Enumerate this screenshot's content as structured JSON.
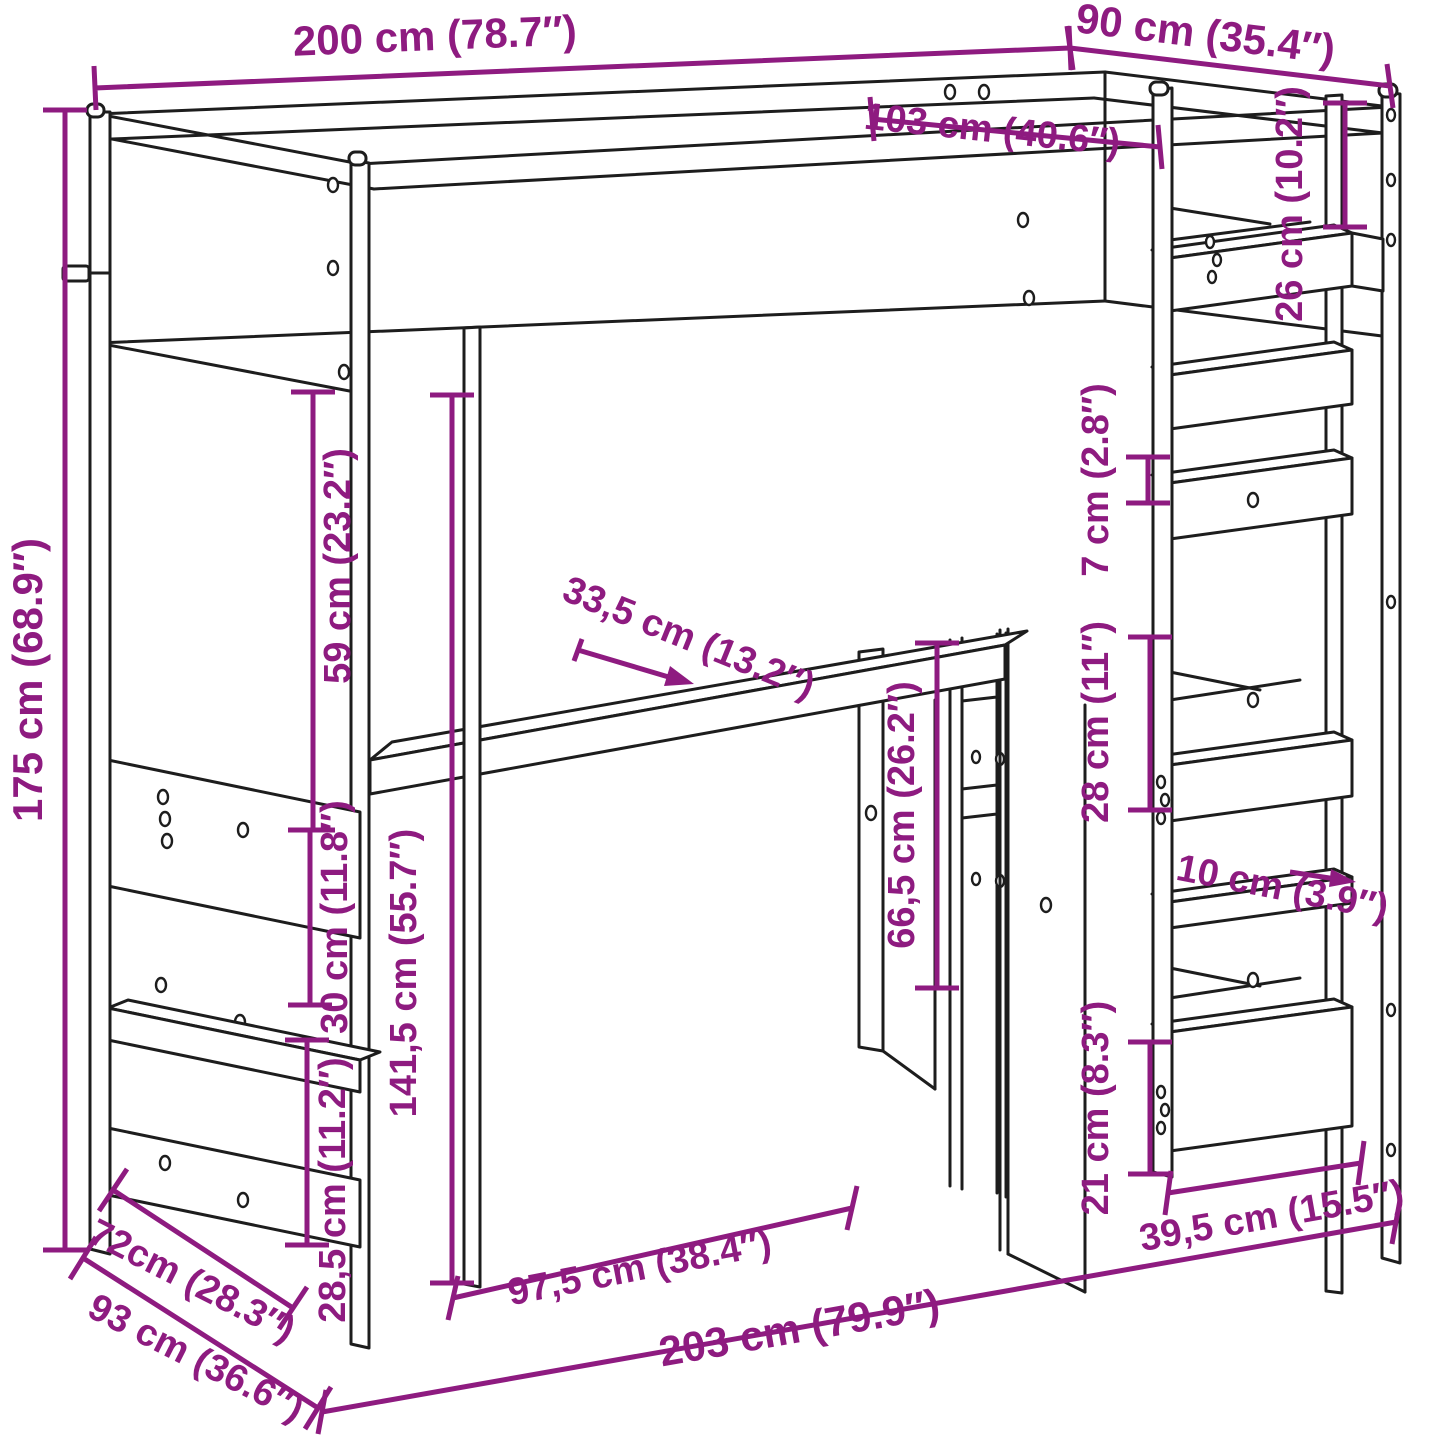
{
  "diagram": {
    "type": "furniture-dimension-diagram",
    "subject": "loft bed with desk and shelving tower, line drawing with dimension callouts",
    "units": [
      "cm",
      "in"
    ],
    "accent_color": "#8e1b80",
    "line_color": "#1d1d1d",
    "background_color": "#ffffff",
    "dimensions": [
      {
        "id": "overall-length-top",
        "label": "200 cm (78.7″)",
        "value_cm": 200,
        "value_in": 78.7
      },
      {
        "id": "overall-depth-top",
        "label": "90 cm (35.4″)",
        "value_cm": 90,
        "value_in": 35.4
      },
      {
        "id": "inner-top-length",
        "label": "103 cm (40.6″)",
        "value_cm": 103,
        "value_in": 40.6
      },
      {
        "id": "top-shelf-offset",
        "label": "26 cm (10.2″)",
        "value_cm": 26,
        "value_in": 10.2
      },
      {
        "id": "shelf-gap-small",
        "label": "7 cm (2.8″)",
        "value_cm": 7,
        "value_in": 2.8
      },
      {
        "id": "shelf-gap-mid",
        "label": "28 cm (11″)",
        "value_cm": 28,
        "value_in": 11
      },
      {
        "id": "overall-height",
        "label": "175 cm (68.9″)",
        "value_cm": 175,
        "value_in": 68.9
      },
      {
        "id": "bed-to-desk-height",
        "label": "59 cm (23.2″)",
        "value_cm": 59,
        "value_in": 23.2
      },
      {
        "id": "under-bed-clearance",
        "label": "141,5 cm (55.7″)",
        "value_cm": 141.5,
        "value_in": 55.7
      },
      {
        "id": "desk-depth",
        "label": "33,5 cm (13.2″)",
        "value_cm": 33.5,
        "value_in": 13.2
      },
      {
        "id": "desk-height",
        "label": "66,5 cm (26.2″)",
        "value_cm": 66.5,
        "value_in": 26.2
      },
      {
        "id": "left-shelf-gap",
        "label": "30 cm (11.8″)",
        "value_cm": 30,
        "value_in": 11.8
      },
      {
        "id": "left-bottom-gap",
        "label": "28,5 cm (11.2″)",
        "value_cm": 28.5,
        "value_in": 11.2
      },
      {
        "id": "left-depth-inner",
        "label": "72cm (28.3″)",
        "value_cm": 72,
        "value_in": 28.3
      },
      {
        "id": "left-depth-outer",
        "label": "93 cm (36.6″)",
        "value_cm": 93,
        "value_in": 36.6
      },
      {
        "id": "desk-width",
        "label": "97,5 cm (38.4″)",
        "value_cm": 97.5,
        "value_in": 38.4
      },
      {
        "id": "overall-length-floor",
        "label": "203 cm (79.9″)",
        "value_cm": 203,
        "value_in": 79.9
      },
      {
        "id": "bottom-shelf-height",
        "label": "21 cm (8.3″)",
        "value_cm": 21,
        "value_in": 8.3
      },
      {
        "id": "tower-width",
        "label": "39,5 cm (15.5″)",
        "value_cm": 39.5,
        "value_in": 15.5
      },
      {
        "id": "tower-shelf-depth",
        "label": "10 cm (3.9″)",
        "value_cm": 10,
        "value_in": 3.9
      }
    ]
  }
}
